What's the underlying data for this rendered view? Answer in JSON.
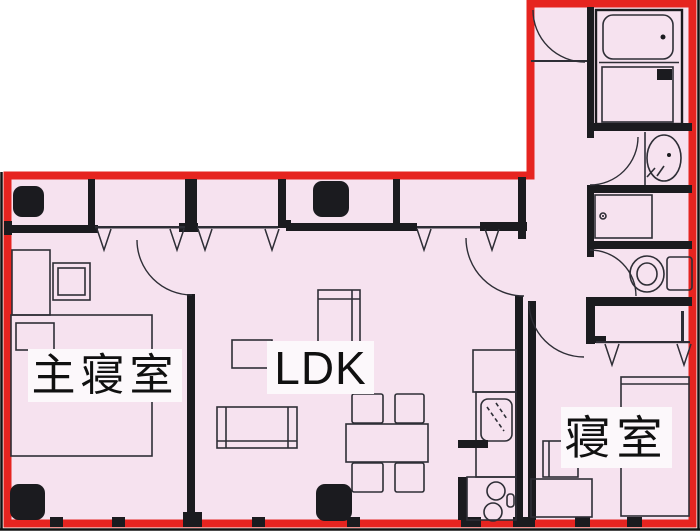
{
  "title": "apartment-floor-plan",
  "rooms": [
    {
      "name": "master-bedroom",
      "label": "主寝室"
    },
    {
      "name": "ldk",
      "label": "LDK"
    },
    {
      "name": "bedroom",
      "label": "寝室"
    }
  ],
  "fixtures": [
    "bathtub",
    "washing-machine",
    "washbasin",
    "storage-cabinet",
    "toilet",
    "refrigerator",
    "kitchen-sink",
    "stove",
    "dining-table",
    "dining-chair",
    "sofa",
    "coffee-table",
    "desk",
    "bed",
    "pillow",
    "nightstand",
    "dresser",
    "air-conditioner",
    "door-swing",
    "window-mark",
    "entrance-door"
  ],
  "colors": {
    "outline_red": "#e62420",
    "floor_pink": "#f6e2ef",
    "wall_black": "#1b1b1f",
    "line_dark": "#2e2e36",
    "label_bg": "#fcf8fb",
    "label_text": "#101010",
    "page_bg": "#ffffff"
  }
}
